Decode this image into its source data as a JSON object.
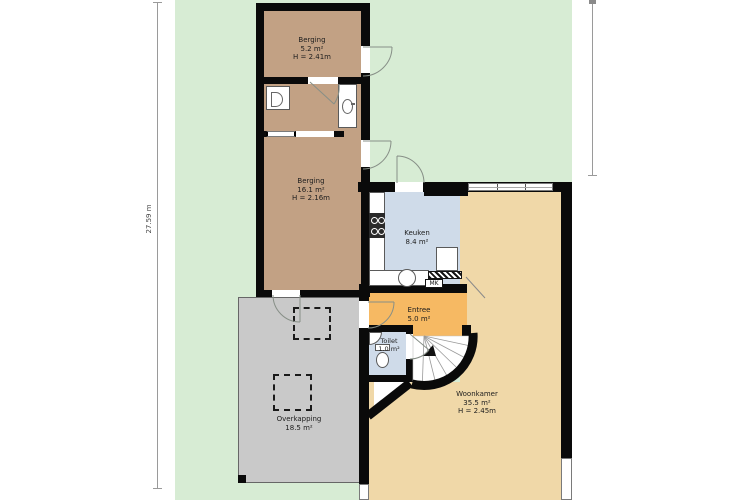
{
  "plan": {
    "title": "floor-plan",
    "rooms": [
      {
        "id": "berging-top",
        "name": "Berging",
        "area": "5.2 m²",
        "height": "H = 2.41m"
      },
      {
        "id": "berging-main",
        "name": "Berging",
        "area": "16.1 m²",
        "height": "H = 2.16m"
      },
      {
        "id": "keuken",
        "name": "Keuken",
        "area": "8.4 m²",
        "height": ""
      },
      {
        "id": "entree",
        "name": "Entree",
        "area": "5.0 m²",
        "height": ""
      },
      {
        "id": "toilet",
        "name": "Toilet",
        "area": "1.0 m²",
        "height": ""
      },
      {
        "id": "woonkamer",
        "name": "Woonkamer",
        "area": "35.5 m²",
        "height": "H = 2.45m"
      },
      {
        "id": "overkapping",
        "name": "Overkapping",
        "area": "18.5 m²",
        "height": ""
      }
    ],
    "annotations": {
      "meter_cupboard": "MK"
    },
    "dimensions": {
      "left_total": "27.59 m"
    },
    "colors": {
      "garden": "#d7ecd4",
      "berging": "#c2a184",
      "kitchen": "#cfdbe9",
      "living": "#f0d8a8",
      "entry": "#f6b963",
      "canopy": "#c9c9c9",
      "wall": "#0a0a0a"
    }
  }
}
